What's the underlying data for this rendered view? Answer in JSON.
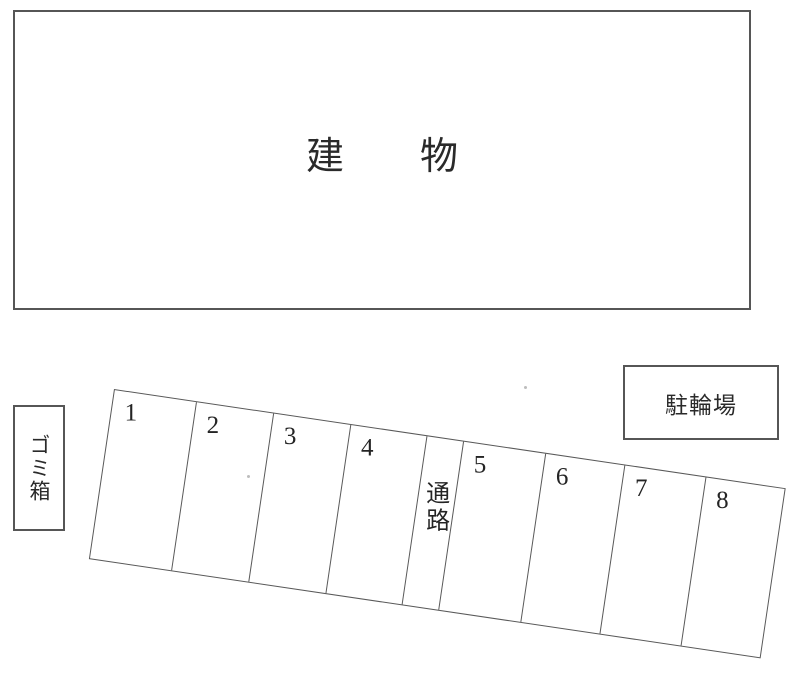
{
  "plan": {
    "building": {
      "label": "建　　物"
    },
    "trash_box": {
      "label": "ゴミ箱"
    },
    "bicycle_parking": {
      "label": "駐輪場"
    },
    "parking_lot": {
      "aisle_label": "通路",
      "stalls": [
        {
          "number": "1"
        },
        {
          "number": "2"
        },
        {
          "number": "3"
        },
        {
          "number": "4"
        },
        {
          "number": "5"
        },
        {
          "number": "6"
        },
        {
          "number": "7"
        },
        {
          "number": "8"
        }
      ]
    },
    "colors": {
      "line": "#565656",
      "background": "#ffffff",
      "text": "#242424"
    }
  }
}
